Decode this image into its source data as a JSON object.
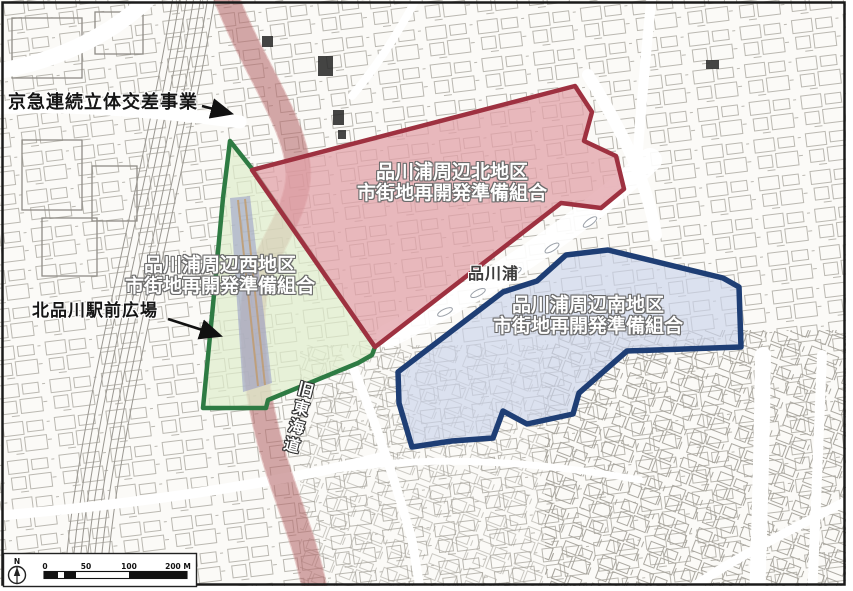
{
  "map": {
    "annotations": {
      "keikyu_project": "京急連続立体交差事業",
      "kitashinagawa_plaza": "北品川駅前広場",
      "shinagawa_ura": "品川浦",
      "kyu_tokaido": "旧東海道"
    },
    "districts": {
      "north": {
        "name_line1": "品川浦周辺北地区",
        "name_line2": "市街地再開発準備組合",
        "border_color": "#9e3140",
        "fill_color": "#e2a2a8"
      },
      "west": {
        "name_line1": "品川浦周辺西地区",
        "name_line2": "市街地再開発準備組合",
        "border_color": "#2e7b43",
        "fill_color": "#dfedcc"
      },
      "south": {
        "name_line1": "品川浦周辺南地区",
        "name_line2": "市街地再開発準備組合",
        "border_color": "#1e3e75",
        "fill_color": "#ccd4ea"
      }
    },
    "scale_bar": {
      "compass": "N",
      "tick_0": "0",
      "tick_50": "50",
      "tick_100": "100",
      "tick_200": "200 M"
    }
  }
}
